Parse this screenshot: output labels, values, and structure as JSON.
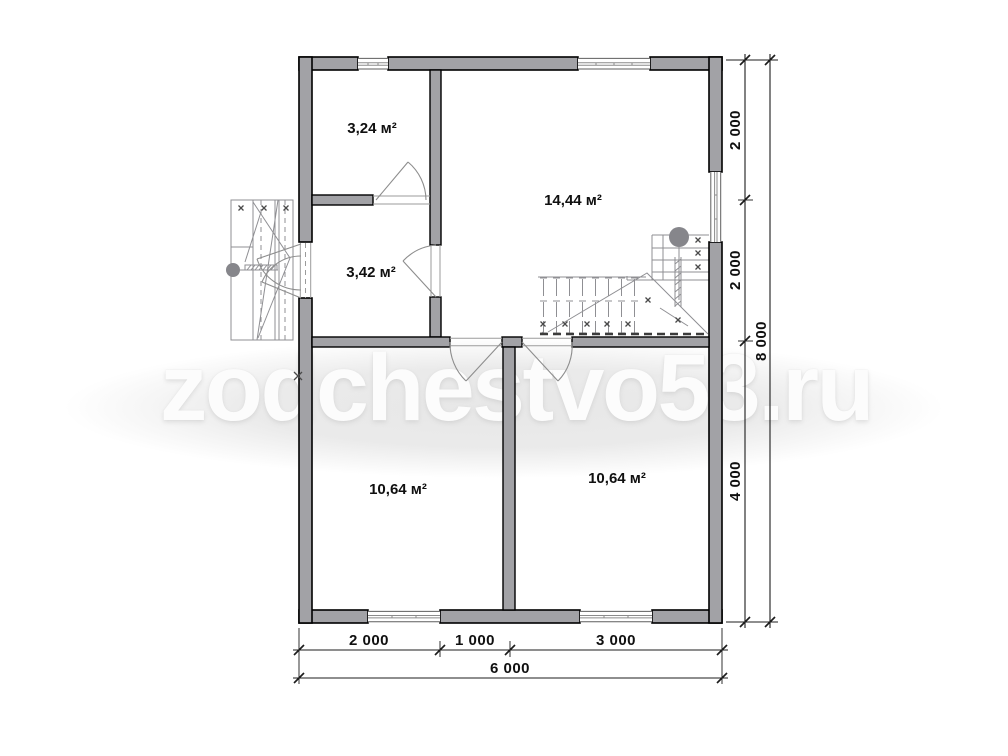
{
  "watermark": {
    "text": "zodchestvo53.ru"
  },
  "rooms": [
    {
      "id": "top-left",
      "area_label": "3,24 м²"
    },
    {
      "id": "living",
      "area_label": "14,44 м²"
    },
    {
      "id": "entry",
      "area_label": "3,42 м²"
    },
    {
      "id": "bottom-left",
      "area_label": "10,64 м²"
    },
    {
      "id": "bottom-right",
      "area_label": "10,64 м²"
    }
  ],
  "dimensions": {
    "right": {
      "segments": [
        "2 000",
        "2 000",
        "4 000"
      ],
      "total": "8 000"
    },
    "bottom": {
      "segments": [
        "2 000",
        "1 000",
        "3 000"
      ],
      "total": "6 000"
    }
  },
  "colors": {
    "wall_fill": "#a2a2a6",
    "wall_outline": "#000000",
    "thin_line": "#8f8f93",
    "dim_color": "#1c1c1c",
    "watermark_text": "#fcfcfc",
    "watermark_blob": "#e7e7e7"
  }
}
